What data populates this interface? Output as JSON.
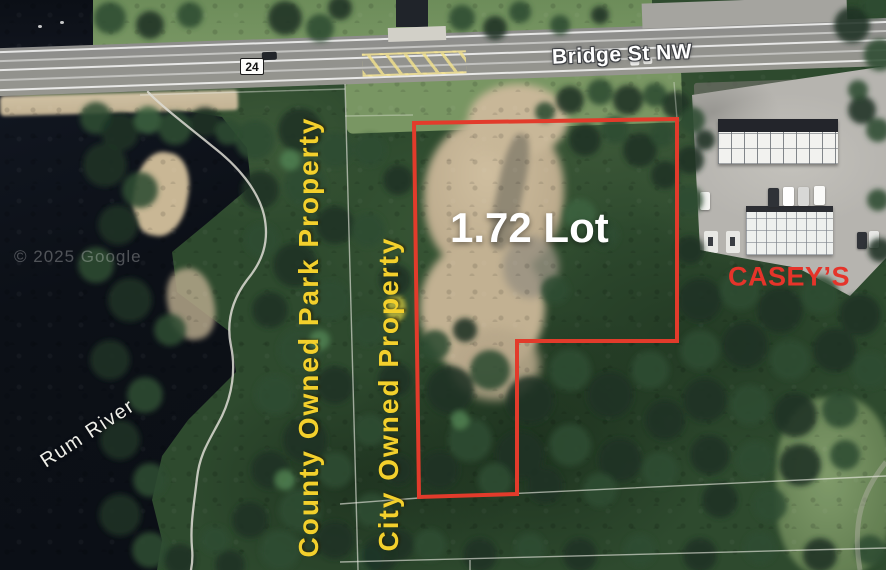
{
  "map": {
    "route_shield": "24",
    "street_name": "Bridge St NW",
    "lot_label": "1.72 Lot",
    "county_label": "County Owned Park Property",
    "city_label": "City Owned Property",
    "caseys_label": "CASEY’S",
    "river_label": "Rum River",
    "watermark": "© 2025 Google",
    "colors": {
      "boundary_red": "#e23b2b",
      "ownership_yellow": "#f3d02c",
      "caseys_red": "#e5342a",
      "street_label": "#ffffff"
    }
  }
}
